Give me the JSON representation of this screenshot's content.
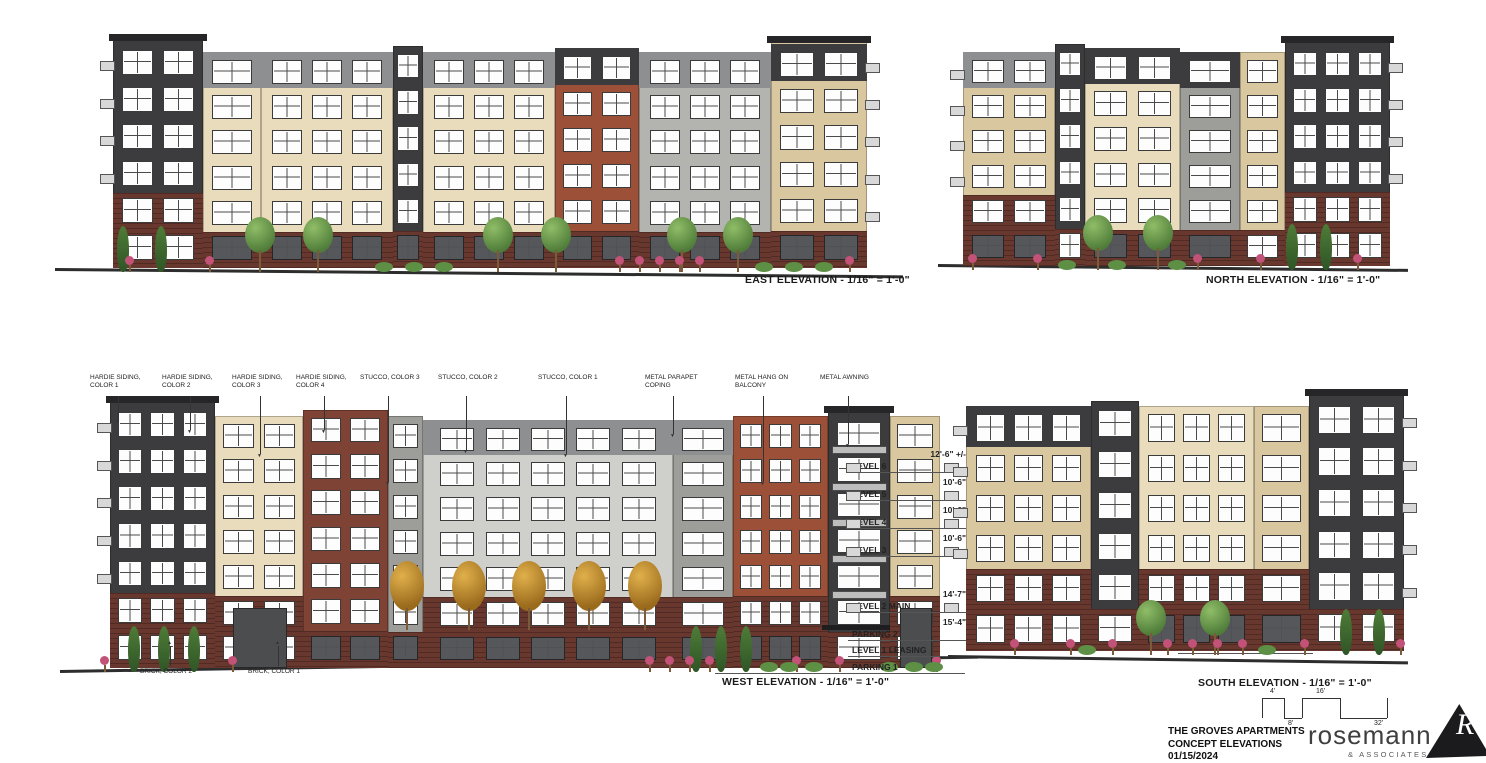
{
  "drawing": {
    "title_block": {
      "project": "THE GROVES APARTMENTS",
      "sheet": "CONCEPT ELEVATIONS",
      "date": "01/15/2024"
    },
    "logo": {
      "name": "rosemann",
      "suffix": "& ASSOCIATES",
      "suffix2": "P.C."
    },
    "scale_bar": {
      "ticks": [
        "4'",
        "8'",
        "16'",
        "32'"
      ]
    }
  },
  "elevations": {
    "east": {
      "caption": "EAST ELEVATION - 1/16\" = 1'-0\""
    },
    "north": {
      "caption": "NORTH ELEVATION - 1/16\" = 1'-0\""
    },
    "west": {
      "caption": "WEST ELEVATION - 1/16\" = 1'-0\""
    },
    "south": {
      "caption": "SOUTH ELEVATION - 1/16\" = 1'-0\"",
      "note": "LOWER PARKING ENTRY"
    }
  },
  "levels": [
    {
      "name": "LEVEL 6",
      "dim": "12'-6\" +/-",
      "y": 102
    },
    {
      "name": "LEVEL 5",
      "dim": "10'-6\"",
      "y": 130
    },
    {
      "name": "LEVEL 4",
      "dim": "10'-6\"",
      "y": 158
    },
    {
      "name": "LEVEL 3",
      "dim": "10'-6\"",
      "y": 186
    },
    {
      "name": "LEVEL 2  MAIN",
      "dim": "14'-7\"",
      "y": 242
    },
    {
      "name": "PARKING 2",
      "dim": "15'-4\"",
      "y": 270
    },
    {
      "name": "LEVEL 1  LEASING",
      "dim": "",
      "y": 286
    },
    {
      "name": "PARKING 1",
      "dim": "",
      "y": 303
    }
  ],
  "callouts": {
    "materials": [
      {
        "label": "HARDIE SIDING, COLOR 1",
        "x": 30,
        "drop": 24
      },
      {
        "label": "HARDIE SIDING, COLOR 2",
        "x": 102,
        "drop": 34
      },
      {
        "label": "HARDIE SIDING, COLOR 3",
        "x": 172,
        "drop": 58
      },
      {
        "label": "HARDIE SIDING, COLOR 4",
        "x": 236,
        "drop": 34
      },
      {
        "label": "STUCCO, COLOR 3",
        "x": 300,
        "drop": 86
      },
      {
        "label": "STUCCO, COLOR 2",
        "x": 378,
        "drop": 54
      },
      {
        "label": "STUCCO, COLOR 1",
        "x": 478,
        "drop": 58
      },
      {
        "label": "METAL PARAPET COPING",
        "x": 585,
        "drop": 38
      },
      {
        "label": "METAL HANG ON BALCONY",
        "x": 675,
        "drop": 86
      },
      {
        "label": "METAL AWNING",
        "x": 760,
        "drop": 48
      }
    ],
    "bricks": [
      {
        "label": "BRICK, COLOR 2",
        "x": 80
      },
      {
        "label": "BRICK, COLOR 1",
        "x": 188
      }
    ]
  },
  "palette": {
    "charcoal": "#3c3c3e",
    "charcoal_dark": "#262628",
    "gray_band": "#8e8f90",
    "gray_light": "#cfcfcb",
    "gray_mid": "#9d9d99",
    "gray_pier": "#b3b3af",
    "cream": "#e9dcbc",
    "tan": "#d9c7a0",
    "gray_panel": "#9a9287",
    "brick_dark": "#68372d",
    "brick_red": "#9c5038",
    "brick_brown": "#7e4335",
    "window_frame": "#3b3b3b",
    "storefront": "#55575b",
    "ground": "#2d2d2d",
    "tree_green": "#679a4b",
    "tree_dark": "#3f6b33",
    "tree_fall": "#c98e2e",
    "flower": "#c25277"
  },
  "facades": {
    "east": {
      "left": 58,
      "bottom": 24,
      "groundBottom": 20,
      "segments": [
        {
          "w": 90,
          "h": 234,
          "color": "charcoal",
          "cap": 1,
          "rows": 6,
          "cols": 2,
          "base": {
            "rows": 2,
            "color": "brick_dark"
          },
          "balcL": 1
        },
        {
          "w": 58,
          "h": 216,
          "color": "cream",
          "rows": 6,
          "cols": 1,
          "band": {
            "rows": 1,
            "color": "gray_band"
          },
          "base": {
            "rows": 1,
            "color": "brick_dark"
          },
          "store": 1
        },
        {
          "w": 132,
          "h": 216,
          "color": "cream",
          "rows": 6,
          "cols": 3,
          "band": {
            "rows": 1,
            "color": "gray_band"
          },
          "base": {
            "rows": 1,
            "color": "brick_dark"
          },
          "store": 1
        },
        {
          "w": 30,
          "h": 222,
          "color": "charcoal",
          "rows": 6,
          "cols": 1,
          "base": {
            "rows": 1,
            "color": "brick_dark"
          },
          "store": 1
        },
        {
          "w": 132,
          "h": 216,
          "color": "cream",
          "rows": 6,
          "cols": 3,
          "band": {
            "rows": 1,
            "color": "gray_band"
          },
          "base": {
            "rows": 1,
            "color": "brick_dark"
          },
          "store": 1
        },
        {
          "w": 84,
          "h": 220,
          "color": "brick_red",
          "rows": 6,
          "cols": 2,
          "band": {
            "rows": 1,
            "color": "charcoal"
          },
          "base": {
            "rows": 1,
            "color": "brick_dark"
          },
          "store": 1
        },
        {
          "w": 132,
          "h": 216,
          "color": "gray_pier",
          "rows": 6,
          "cols": 3,
          "band": {
            "rows": 1,
            "color": "gray_band"
          },
          "base": {
            "rows": 1,
            "color": "brick_dark"
          },
          "store": 1
        },
        {
          "w": 96,
          "h": 232,
          "color": "tan",
          "cap": 1,
          "rows": 6,
          "cols": 2,
          "band": {
            "rows": 1,
            "color": "charcoal"
          },
          "base": {
            "rows": 1,
            "color": "brick_dark"
          },
          "store": 1,
          "balcR": 1
        }
      ],
      "trees": [
        {
          "x": 62,
          "t": "cyp"
        },
        {
          "x": 100,
          "t": "cyp"
        },
        {
          "x": 190,
          "t": "tree"
        },
        {
          "x": 248,
          "t": "tree"
        },
        {
          "x": 428,
          "t": "tree"
        },
        {
          "x": 486,
          "t": "tree"
        },
        {
          "x": 612,
          "t": "tree"
        },
        {
          "x": 668,
          "t": "tree"
        },
        {
          "x": 70,
          "t": "fl"
        },
        {
          "x": 150,
          "t": "fl"
        },
        {
          "x": 560,
          "t": "fl"
        },
        {
          "x": 580,
          "t": "fl"
        },
        {
          "x": 600,
          "t": "fl"
        },
        {
          "x": 620,
          "t": "fl"
        },
        {
          "x": 640,
          "t": "fl"
        },
        {
          "x": 790,
          "t": "fl"
        },
        {
          "x": 320,
          "t": "sh"
        },
        {
          "x": 350,
          "t": "sh"
        },
        {
          "x": 380,
          "t": "sh"
        },
        {
          "x": 700,
          "t": "sh"
        },
        {
          "x": 730,
          "t": "sh"
        },
        {
          "x": 760,
          "t": "sh"
        }
      ]
    },
    "north": {
      "left": 25,
      "bottom": 26,
      "groundBottom": 22,
      "segments": [
        {
          "w": 92,
          "h": 214,
          "color": "tan",
          "rows": 6,
          "cols": 2,
          "band": {
            "rows": 1,
            "color": "gray_band"
          },
          "base": {
            "rows": 2,
            "color": "brick_dark"
          },
          "store": 1,
          "balcL": 1
        },
        {
          "w": 30,
          "h": 222,
          "color": "charcoal",
          "rows": 6,
          "cols": 1,
          "base": {
            "rows": 1,
            "color": "brick_dark"
          }
        },
        {
          "w": 95,
          "h": 218,
          "color": "cream",
          "rows": 6,
          "cols": 2,
          "band": {
            "rows": 1,
            "color": "charcoal"
          },
          "base": {
            "rows": 1,
            "color": "brick_dark"
          },
          "store": 1
        },
        {
          "w": 60,
          "h": 214,
          "color": "gray_mid",
          "rows": 6,
          "cols": 1,
          "band": {
            "rows": 1,
            "color": "charcoal"
          },
          "base": {
            "rows": 1,
            "color": "brick_dark"
          },
          "store": 1
        },
        {
          "w": 45,
          "h": 214,
          "color": "tan",
          "rows": 6,
          "cols": 1,
          "base": {
            "rows": 1,
            "color": "brick_dark"
          }
        },
        {
          "w": 105,
          "h": 230,
          "color": "charcoal",
          "cap": 1,
          "rows": 6,
          "cols": 3,
          "base": {
            "rows": 2,
            "color": "brick_dark"
          },
          "balcR": 1
        }
      ],
      "trees": [
        {
          "x": 145,
          "t": "tree"
        },
        {
          "x": 205,
          "t": "tree"
        },
        {
          "x": 348,
          "t": "cyp"
        },
        {
          "x": 382,
          "t": "cyp"
        },
        {
          "x": 30,
          "t": "fl"
        },
        {
          "x": 95,
          "t": "fl"
        },
        {
          "x": 255,
          "t": "fl"
        },
        {
          "x": 318,
          "t": "fl"
        },
        {
          "x": 415,
          "t": "fl"
        },
        {
          "x": 120,
          "t": "sh"
        },
        {
          "x": 170,
          "t": "sh"
        },
        {
          "x": 230,
          "t": "sh"
        }
      ]
    },
    "west": {
      "left": 50,
      "bottom": 32,
      "groundBottom": 28,
      "segments": [
        {
          "w": 105,
          "h": 272,
          "color": "charcoal",
          "cap": 1,
          "rows": 7,
          "cols": 3,
          "base": {
            "rows": 2,
            "color": "brick_dark"
          },
          "balcL": 1
        },
        {
          "w": 88,
          "h": 252,
          "color": "cream",
          "rows": 7,
          "cols": 2,
          "base": {
            "rows": 2,
            "color": "brick_dark"
          },
          "door": 1
        },
        {
          "w": 85,
          "h": 258,
          "color": "brick_brown",
          "rows": 7,
          "cols": 2,
          "base": {
            "rows": 1,
            "color": "brick_dark"
          },
          "store": 1
        },
        {
          "w": 35,
          "h": 252,
          "color": "gray_mid",
          "rows": 7,
          "cols": 1,
          "base": {
            "rows": 1,
            "color": "brick_dark"
          },
          "store": 1
        },
        {
          "w": 250,
          "h": 248,
          "color": "gray_light",
          "rows": 7,
          "cols": 5,
          "band": {
            "rows": 1,
            "color": "gray_band"
          },
          "base": {
            "rows": 2,
            "color": "brick_dark"
          },
          "store": 1
        },
        {
          "w": 60,
          "h": 248,
          "color": "gray_mid",
          "rows": 7,
          "cols": 1,
          "band": {
            "rows": 1,
            "color": "gray_band"
          },
          "base": {
            "rows": 2,
            "color": "brick_dark"
          },
          "store": 1
        },
        {
          "w": 95,
          "h": 252,
          "color": "brick_red",
          "rows": 7,
          "cols": 3,
          "base": {
            "rows": 2,
            "color": "brick_dark"
          },
          "store": 1
        },
        {
          "w": 62,
          "h": 262,
          "color": "charcoal",
          "cap": 1,
          "rows": 7,
          "cols": 1,
          "balcF": 1,
          "base": {
            "rows": 1,
            "color": "brick_dark"
          },
          "awning": 1
        },
        {
          "w": 50,
          "h": 252,
          "color": "tan",
          "rows": 7,
          "cols": 1,
          "base": {
            "rows": 2,
            "color": "brick_dark"
          },
          "door": 1
        }
      ],
      "trees": [
        {
          "x": 68,
          "t": "cyp"
        },
        {
          "x": 98,
          "t": "cyp"
        },
        {
          "x": 128,
          "t": "cyp"
        },
        {
          "x": 330,
          "t": "fall",
          "dy": 42
        },
        {
          "x": 392,
          "t": "fall",
          "dy": 42
        },
        {
          "x": 452,
          "t": "fall",
          "dy": 42
        },
        {
          "x": 512,
          "t": "fall",
          "dy": 42
        },
        {
          "x": 568,
          "t": "fall",
          "dy": 42
        },
        {
          "x": 630,
          "t": "cyp"
        },
        {
          "x": 655,
          "t": "cyp"
        },
        {
          "x": 680,
          "t": "cyp"
        },
        {
          "x": 40,
          "t": "fl"
        },
        {
          "x": 168,
          "t": "fl"
        },
        {
          "x": 585,
          "t": "fl"
        },
        {
          "x": 605,
          "t": "fl"
        },
        {
          "x": 625,
          "t": "fl"
        },
        {
          "x": 645,
          "t": "fl"
        },
        {
          "x": 732,
          "t": "fl"
        },
        {
          "x": 775,
          "t": "fl"
        },
        {
          "x": 872,
          "t": "fl"
        },
        {
          "x": 700,
          "t": "sh"
        },
        {
          "x": 720,
          "t": "sh"
        },
        {
          "x": 745,
          "t": "sh"
        },
        {
          "x": 820,
          "t": "sh"
        },
        {
          "x": 845,
          "t": "sh"
        },
        {
          "x": 865,
          "t": "sh"
        }
      ]
    },
    "south": {
      "left": 18,
      "bottom": 42,
      "groundBottom": 38,
      "segments": [
        {
          "w": 125,
          "h": 245,
          "color": "tan",
          "rows": 6,
          "cols": 3,
          "band": {
            "rows": 1,
            "color": "charcoal"
          },
          "base": {
            "rows": 2,
            "color": "brick_dark"
          },
          "balcL": 1
        },
        {
          "w": 48,
          "h": 250,
          "color": "charcoal",
          "rows": 6,
          "cols": 1,
          "base": {
            "rows": 1,
            "color": "brick_dark"
          }
        },
        {
          "w": 115,
          "h": 245,
          "color": "cream",
          "rows": 6,
          "cols": 3,
          "base": {
            "rows": 2,
            "color": "brick_dark"
          },
          "store": 1
        },
        {
          "w": 55,
          "h": 245,
          "color": "tan",
          "rows": 6,
          "cols": 1,
          "base": {
            "rows": 2,
            "color": "brick_dark"
          },
          "store": 1
        },
        {
          "w": 95,
          "h": 262,
          "color": "charcoal",
          "cap": 1,
          "rows": 6,
          "cols": 2,
          "base": {
            "rows": 1,
            "color": "brick_dark"
          },
          "balcR": 1
        }
      ],
      "trees": [
        {
          "x": 188,
          "t": "tree"
        },
        {
          "x": 252,
          "t": "tree"
        },
        {
          "x": 392,
          "t": "cyp"
        },
        {
          "x": 425,
          "t": "cyp"
        },
        {
          "x": 62,
          "t": "fl"
        },
        {
          "x": 118,
          "t": "fl"
        },
        {
          "x": 160,
          "t": "fl"
        },
        {
          "x": 215,
          "t": "fl"
        },
        {
          "x": 240,
          "t": "fl"
        },
        {
          "x": 265,
          "t": "fl"
        },
        {
          "x": 290,
          "t": "fl"
        },
        {
          "x": 352,
          "t": "fl"
        },
        {
          "x": 448,
          "t": "fl"
        },
        {
          "x": 130,
          "t": "sh"
        },
        {
          "x": 310,
          "t": "sh"
        }
      ]
    }
  }
}
